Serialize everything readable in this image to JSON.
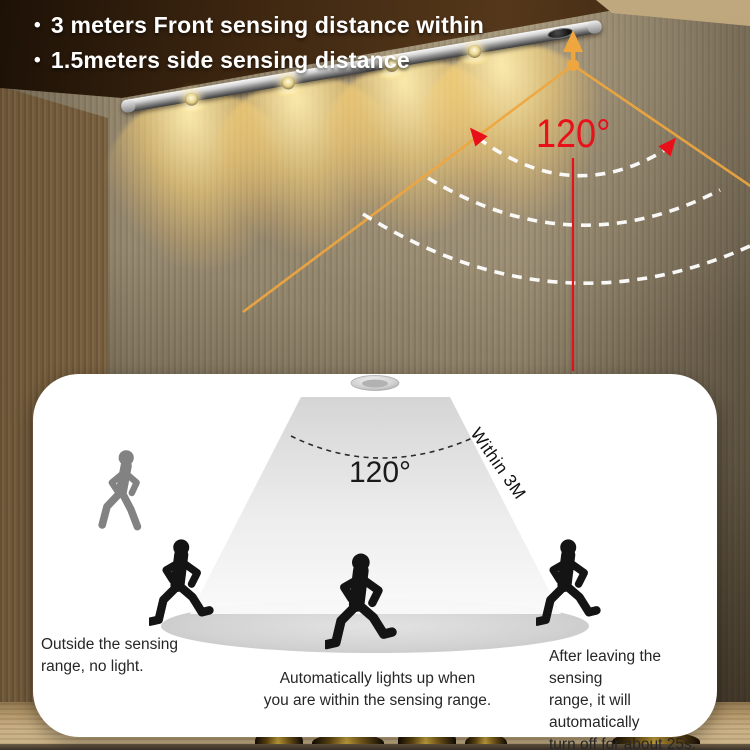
{
  "colors": {
    "accent_orange": "#efa63e",
    "alert_red": "#e8111a",
    "panel_bg": "#ffffff",
    "figure_gray": "#828282",
    "figure_black": "#141414",
    "arc_white": "#ffffff"
  },
  "top_annotations": {
    "bullet": "•",
    "line1": "3 meters Front sensing distance within",
    "line2": "1.5meters side sensing distance"
  },
  "wall_overlay": {
    "angle_label": "120°"
  },
  "panel": {
    "angle_label": "120°",
    "range_label": "Within 3M",
    "caption_left": "Outside the sensing\nrange, no light.",
    "caption_center": "Automatically lights up when\nyou are within the sensing range.",
    "caption_right": "After leaving the sensing\nrange, it will automatically\nturn off for about 25s."
  },
  "icons": {
    "led_lens": "glowing circular lens",
    "pir_sensor": "dark oval motion sensor window",
    "ceiling_sensor": "round recessed sensor puck",
    "walking_person": "gray walking pictogram",
    "running_person": "black running silhouette"
  }
}
